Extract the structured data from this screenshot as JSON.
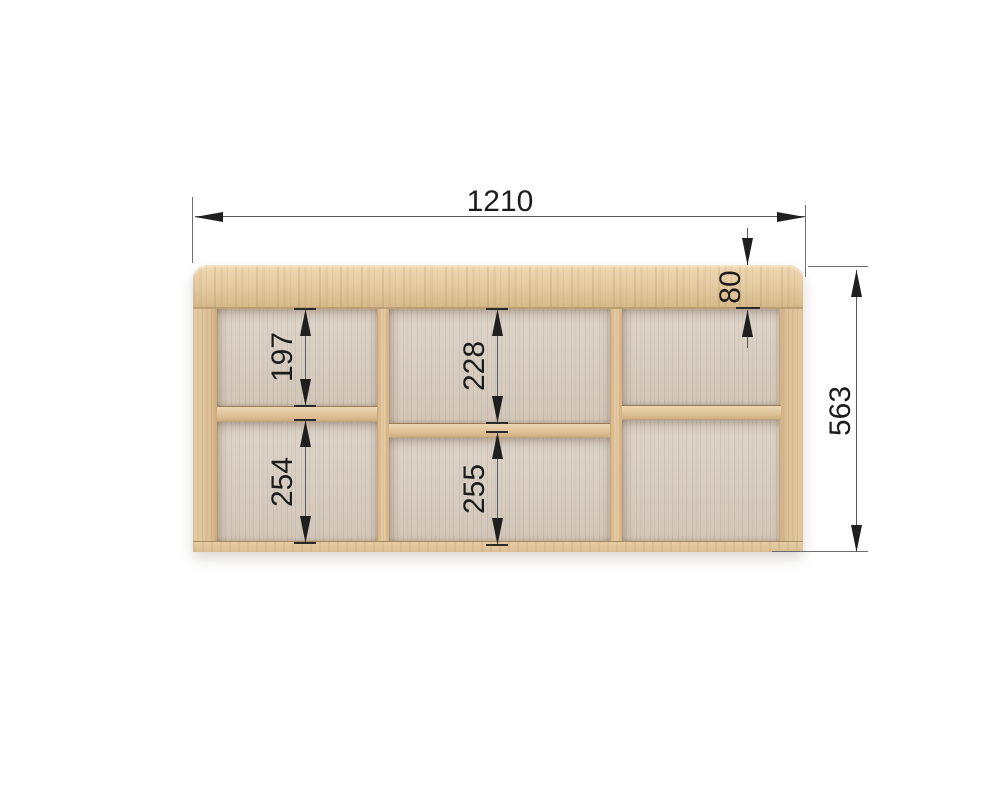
{
  "drawing": {
    "type": "furniture-dimension-drawing",
    "object": "wall shelf unit with six compartments",
    "dimensions": {
      "overall_width": "1210",
      "overall_height": "563",
      "top_rail_height": "80",
      "top_left_cell": "197",
      "top_middle_cell": "228",
      "bottom_left_cell": "254",
      "bottom_middle_cell": "255"
    },
    "colors": {
      "background": "#ffffff",
      "wood_frame": "#e0c49a",
      "wood_rail": "#e4c99f",
      "wood_back_panel": "#d8cec2",
      "dimension_line": "#5a5a5a",
      "dimension_text": "#1c1c1c"
    }
  }
}
